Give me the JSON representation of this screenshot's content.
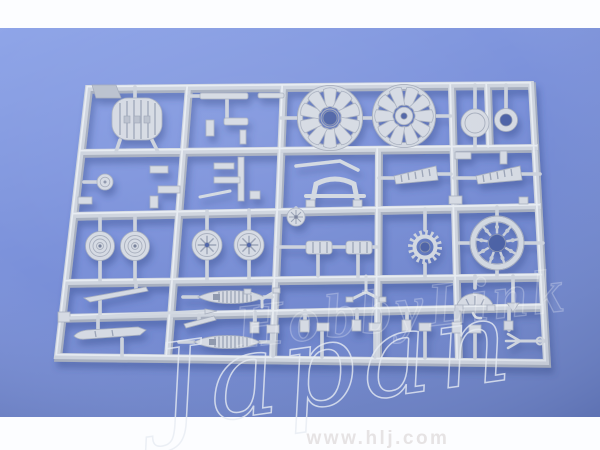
{
  "page": {
    "frame_background": "#fcfdff"
  },
  "photo": {
    "description": "light gray injection-molded model kit parts sprue on blue background",
    "background_blue_top": "#8fa5e8",
    "background_blue_mid": "#7b91da",
    "background_blue_bottom": "#6c82c7",
    "sprue_plastic_color": "#ced4de",
    "sprue_shadow_color": "#34498c"
  },
  "watermark": {
    "outline_text": "HobbyLink",
    "script_text": "Japan",
    "url_text": "www.hlj.com",
    "url_color": "#e6e3e4",
    "mark_stroke_color": "#e6ebf3"
  }
}
